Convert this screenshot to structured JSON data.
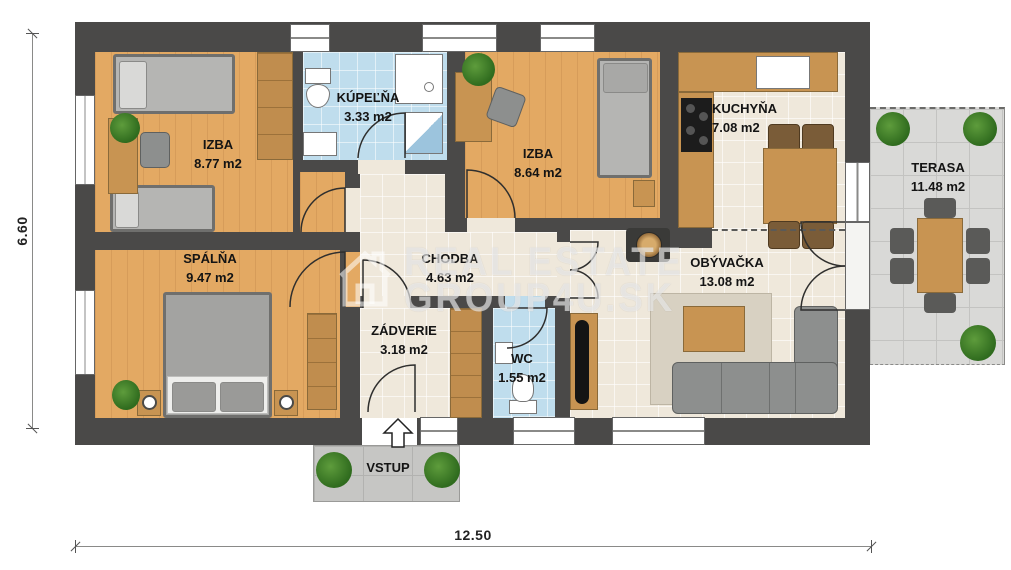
{
  "plan": {
    "rooms": {
      "izba1": {
        "name": "IZBA",
        "area": "8.77 m2"
      },
      "kupelna": {
        "name": "KÚPEĽŇA",
        "area": "3.33 m2"
      },
      "izba2": {
        "name": "IZBA",
        "area": "8.64 m2"
      },
      "kuchyna": {
        "name": "KUCHYŇA",
        "area": "7.08 m2"
      },
      "terasa": {
        "name": "TERASA",
        "area": "11.48 m2"
      },
      "spalna": {
        "name": "SPÁLŇA",
        "area": "9.47 m2"
      },
      "chodba": {
        "name": "CHODBA",
        "area": "4.63 m2"
      },
      "obyvacka": {
        "name": "OBÝVAČKA",
        "area": "13.08 m2"
      },
      "zadverie": {
        "name": "ZÁDVERIE",
        "area": "3.18 m2"
      },
      "wc": {
        "name": "WC",
        "area": "1.55 m2"
      }
    },
    "entrance": {
      "label": "VSTUP"
    },
    "dimensions": {
      "width_label": "12.50",
      "height_label": "6.60"
    },
    "watermark": {
      "line1": "REAL ESTATE",
      "line2": "GROUP4U.SK"
    },
    "colors": {
      "wall": "#4a4948",
      "wood_floor": "#e3a963",
      "bath_blue": "#bfdded",
      "cream_floor": "#efe8db",
      "terrace_gray": "#d9d9d7"
    }
  }
}
